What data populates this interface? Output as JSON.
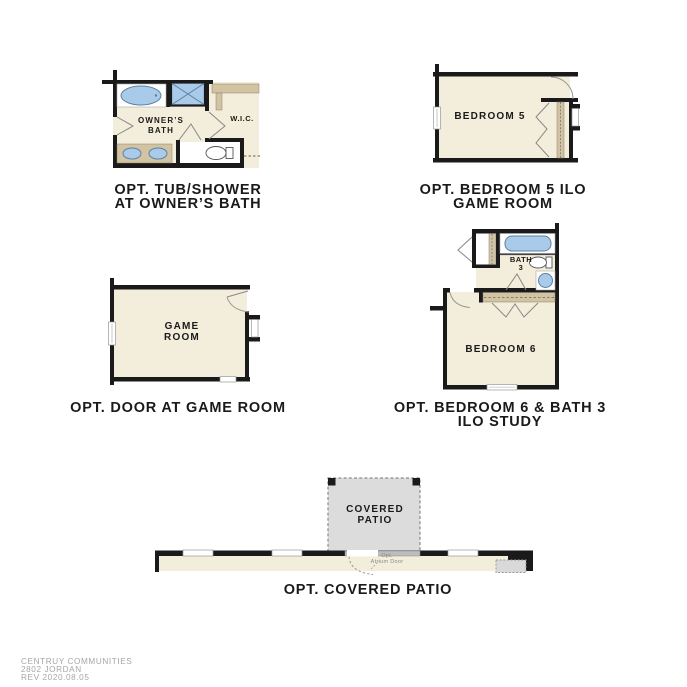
{
  "palette": {
    "wall": "#1a1a1a",
    "floor": "#f2eedb",
    "tan": "#d2c3a3",
    "tan_edge": "#8a7f6a",
    "fixture": "#a9cbe9",
    "fixture_edge": "#5d7fa3",
    "patio": "#dcdcdc",
    "caption_text": "#1a1a1a",
    "footer_text": "#a6a6a6"
  },
  "plans": {
    "owners_bath": {
      "caption_line1": "OPT. TUB/SHOWER",
      "caption_line2": "AT OWNER’S BATH",
      "labels": {
        "room_line1": "OWNER’S",
        "room_line2": "BATH",
        "wic": "W.I.C."
      }
    },
    "bedroom5": {
      "caption_line1": "OPT. BEDROOM 5 ILO",
      "caption_line2": "GAME ROOM",
      "labels": {
        "room": "BEDROOM 5"
      }
    },
    "game_room": {
      "caption": "OPT. DOOR AT GAME ROOM",
      "labels": {
        "room_line1": "GAME",
        "room_line2": "ROOM"
      }
    },
    "bedroom6_bath3": {
      "caption_line1": "OPT. BEDROOM 6 & BATH 3",
      "caption_line2": "ILO STUDY",
      "labels": {
        "bath_line1": "BATH",
        "bath_line2": "3",
        "room": "BEDROOM 6"
      }
    },
    "covered_patio": {
      "caption": "OPT. COVERED PATIO",
      "labels": {
        "patio_line1": "COVERED",
        "patio_line2": "PATIO",
        "atrium_line1": "Opt.",
        "atrium_line2": "Atrium Door"
      }
    }
  },
  "footer": {
    "line1": "CENTRUY COMMUNITIES",
    "line2": "2802 JORDAN",
    "line3": "REV 2020.08.05"
  }
}
